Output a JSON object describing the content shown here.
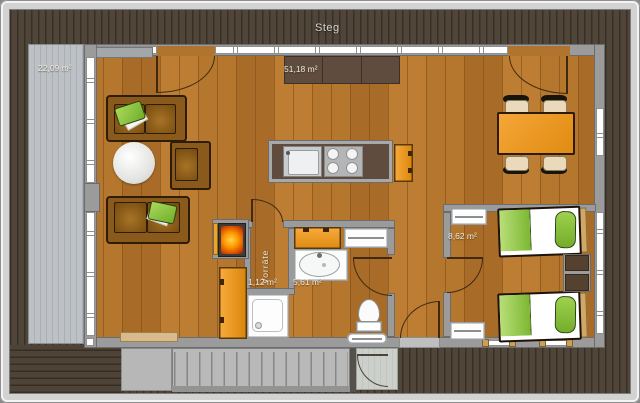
{
  "floorplan": {
    "deck_label": "Steg",
    "terrace": {
      "area": "22,09 m²"
    },
    "living_room": {
      "area": "51,18 m²"
    },
    "bedroom": {
      "area": "8,62 m²"
    },
    "pantry": {
      "name": "Vorräte",
      "area": "1,12 m²"
    },
    "bathroom": {
      "area": "5,61 m²"
    },
    "colors": {
      "deck_wood": "#4a4135",
      "terrace_gray": "#bbbfc3",
      "floor_wood": "#b1742e",
      "wall_gray": "#9b9b9b",
      "furniture_orange": "#ef9b28",
      "sofa_brown": "#8a5a1c",
      "counter_brown": "#5f4c3e",
      "textile_green": "#8cc63e",
      "label_text": "#edece9"
    }
  }
}
